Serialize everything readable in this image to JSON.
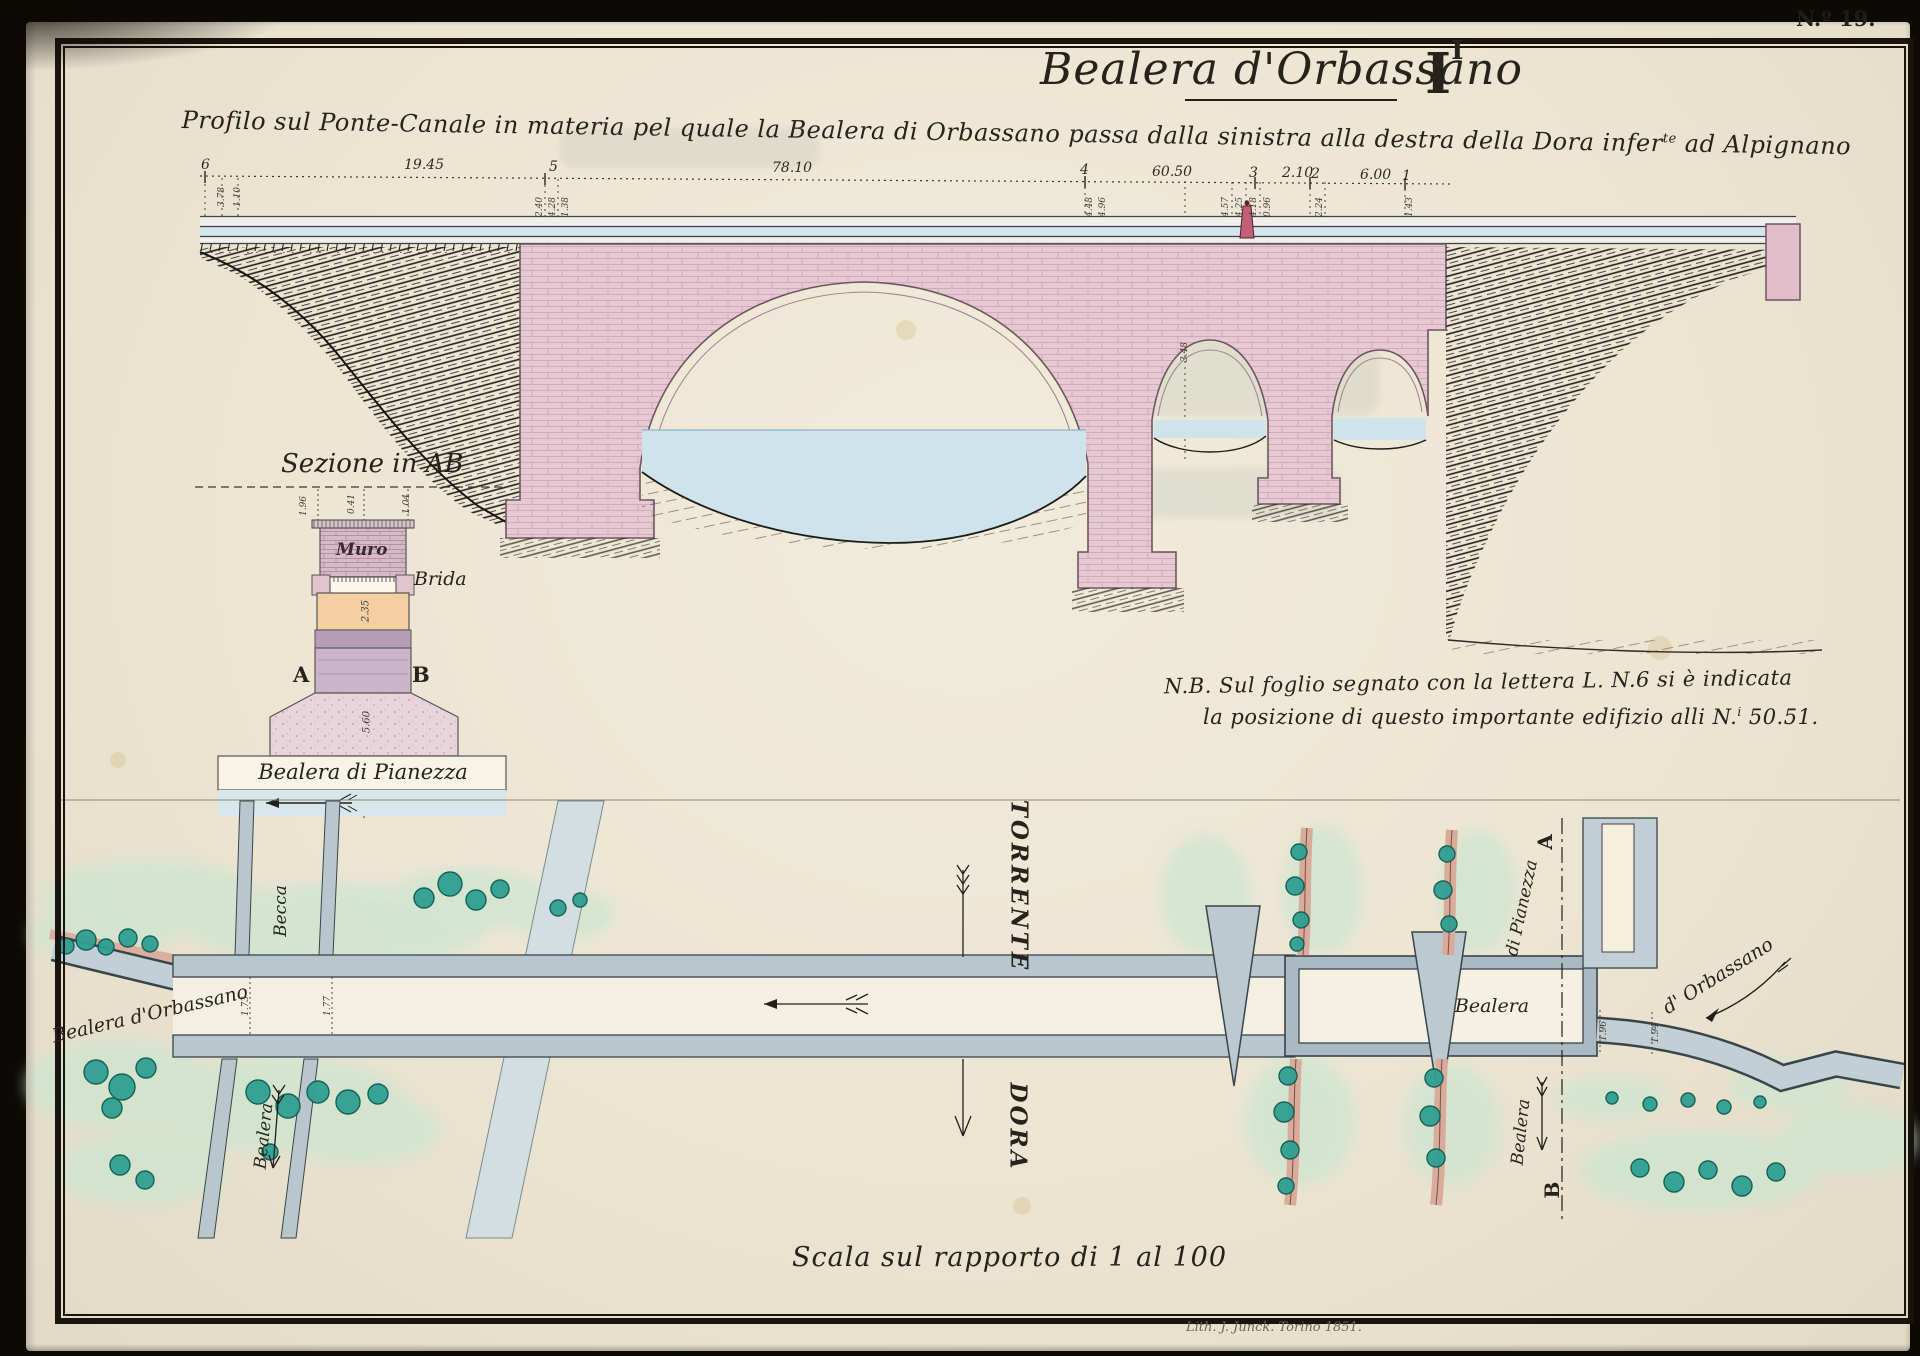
{
  "plate": {
    "number": "N.º 19.",
    "title": "Bealera d'Orbassano",
    "figure_main": "I",
    "figure_sup": "I",
    "subtitle_pre": "Profilo sul Ponte-Canale in materia pel quale la Bealera di Orbassano passa dalla sinistra alla destra della Dora infer",
    "subtitle_sup": "te",
    "subtitle_post": " ad Alpignano",
    "scale_note": "Scala sul rapporto di 1 al 100",
    "credit": "Lith. J. Junck. Torino 1851."
  },
  "note": {
    "line1": "N.B. Sul foglio segnato con la lettera L. N.6  si è indicata",
    "line2_pre": "la posizione di questo importante edifizio alli N.",
    "line2_sup": "i",
    "line2_post": " 50.51."
  },
  "profile": {
    "station_dims": [
      "6",
      "19.45",
      "5",
      "78.10",
      "4",
      "60.50",
      "3",
      "2.10",
      "2",
      "6.00",
      "1"
    ],
    "small_dims": [
      "3.78",
      "1.10",
      "2.40",
      "4.28",
      "1.38",
      "4.48",
      "4.96",
      "4.57",
      "4.25",
      "4.18",
      "0.96",
      "2.24",
      "1.43",
      "3.48"
    ]
  },
  "section": {
    "title": "Sezione in AB",
    "muro": "Muro",
    "brida": "Brida",
    "a": "A",
    "b": "B",
    "canal_label": "Bealera di Pianezza",
    "dims": [
      "1.96",
      "0.41",
      "1.04",
      "2.35",
      "5.60"
    ]
  },
  "plan": {
    "torrente": "TORRENTE",
    "dora": "DORA",
    "becca": "Becca",
    "bealera_orbassano": "Bealera d'Orbassano",
    "bealera_left_road": "Bealera",
    "bealera_canal": "Bealera",
    "di_pianezza": "di Pianezza",
    "bealera_right_road": "Bealera",
    "d_orbassano": "d' Orbassano",
    "a": "A",
    "b": "B",
    "dims": [
      "1.73",
      "1.77",
      "1.96",
      "1.94"
    ]
  },
  "colors": {
    "paper": "#ece5d2",
    "ink": "#26231c",
    "bridge_pink": "#e7c9d3",
    "orange_band": "#f3cfa2",
    "lilac": "#ccb5ca",
    "canal_gray": "#b8c7ce",
    "water_blue": "#cfe3ea",
    "wash_green": "#cde5cf",
    "tree_teal": "#2fa092"
  }
}
